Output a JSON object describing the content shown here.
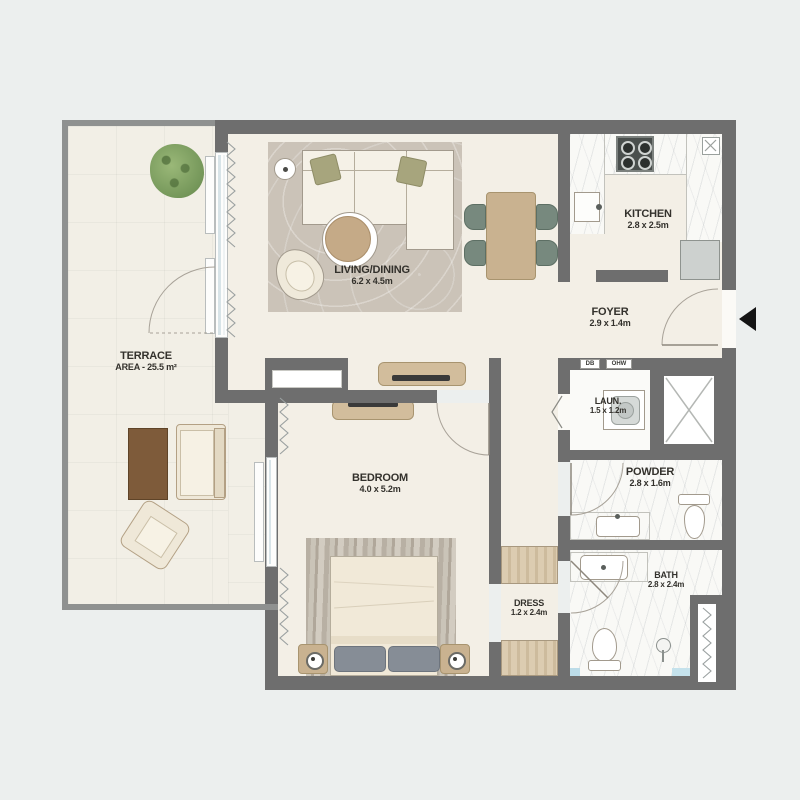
{
  "rooms": {
    "terrace": {
      "name": "TERRACE",
      "dims": "AREA - 25.5 m²"
    },
    "living_dining": {
      "name": "LIVING/DINING",
      "dims": "6.2 x 4.5m"
    },
    "kitchen": {
      "name": "KITCHEN",
      "dims": "2.8 x 2.5m"
    },
    "foyer": {
      "name": "FOYER",
      "dims": "2.9 x 1.4m"
    },
    "laundry": {
      "name": "LAUN.",
      "dims": "1.5 x 1.2m"
    },
    "powder": {
      "name": "POWDER",
      "dims": "2.8 x 1.6m"
    },
    "bedroom": {
      "name": "BEDROOM",
      "dims": "4.0 x 5.2m"
    },
    "dress": {
      "name": "DRESS",
      "dims": "1.2 x 2.4m"
    },
    "bath": {
      "name": "BATH",
      "dims": "2.8 x 2.4m"
    }
  },
  "wall_tags": {
    "db": "DB",
    "ohw": "OHW"
  },
  "colors": {
    "page": "#ecefee",
    "wall": "#6e6e6e",
    "floor_cream": "#f3efe6",
    "marble": "#f9f9f6",
    "rug": "#cbc3b8",
    "wood": "#c9b290",
    "entry_arrow": "#141414"
  }
}
